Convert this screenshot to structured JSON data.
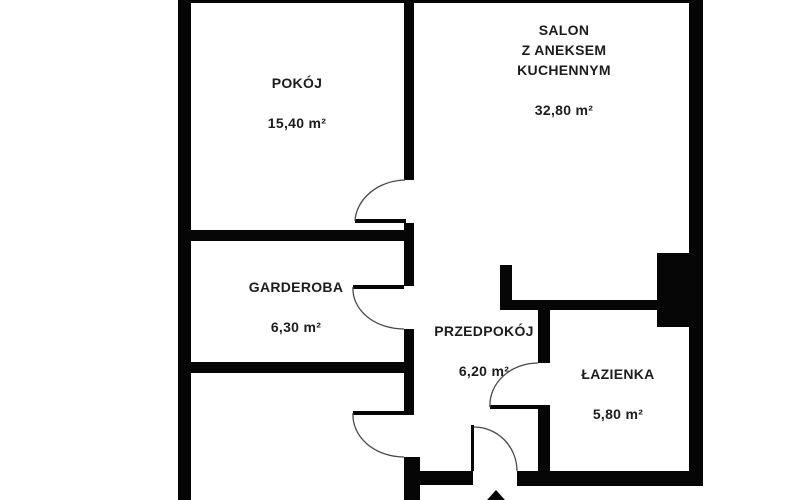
{
  "floorplan": {
    "canvas": {
      "width": 790,
      "height": 500
    },
    "colors": {
      "background": "#ffffff",
      "wall": "#060606",
      "door_arc": "#4a4a4a",
      "text": "#1c1c1c"
    },
    "rooms": [
      {
        "id": "pokoj",
        "name": "POKÓJ",
        "area": "15,40 m²",
        "label": {
          "x": 297,
          "y": 103
        }
      },
      {
        "id": "salon",
        "name": "SALON\nZ ANEKSEM\nKUCHENNYM",
        "area": "32,80 m²",
        "label": {
          "x": 564,
          "y": 70
        }
      },
      {
        "id": "garderoba",
        "name": "GARDEROBA",
        "area": "6,30 m²",
        "label": {
          "x": 296,
          "y": 307
        }
      },
      {
        "id": "przedpokoj",
        "name": "PRZEDPOKÓJ",
        "area": "6,20 m²",
        "label": {
          "x": 484,
          "y": 351
        }
      },
      {
        "id": "lazienka",
        "name": "ŁAZIENKA",
        "area": "5,80 m²",
        "label": {
          "x": 618,
          "y": 394
        }
      }
    ],
    "walls": [
      {
        "name": "outer-wall-left",
        "x": 178,
        "y": 0,
        "w": 13,
        "h": 500
      },
      {
        "name": "outer-wall-top",
        "x": 178,
        "y": 0,
        "w": 525,
        "h": 3
      },
      {
        "name": "outer-wall-right",
        "x": 689,
        "y": 0,
        "w": 14,
        "h": 486
      },
      {
        "name": "divider-wall-segment-a",
        "x": 404,
        "y": 0,
        "w": 10,
        "h": 180
      },
      {
        "name": "divider-wall-segment-b",
        "x": 404,
        "y": 223,
        "w": 10,
        "h": 63
      },
      {
        "name": "divider-wall-segment-c",
        "x": 404,
        "y": 329,
        "w": 10,
        "h": 86
      },
      {
        "name": "divider-wall-segment-d",
        "x": 404,
        "y": 457,
        "w": 16,
        "h": 43
      },
      {
        "name": "wall-pokoj-south",
        "x": 191,
        "y": 230,
        "w": 223,
        "h": 11
      },
      {
        "name": "wall-garderoba-south",
        "x": 191,
        "y": 362,
        "w": 213,
        "h": 11
      },
      {
        "name": "wall-salon-south",
        "x": 500,
        "y": 300,
        "w": 158,
        "h": 10
      },
      {
        "name": "wall-salon-stub",
        "x": 500,
        "y": 265,
        "w": 12,
        "h": 40
      },
      {
        "name": "shaft-block",
        "x": 657,
        "y": 253,
        "w": 32,
        "h": 74
      },
      {
        "name": "wall-lazienka-west-upper",
        "x": 538,
        "y": 303,
        "w": 12,
        "h": 60
      },
      {
        "name": "wall-lazienka-west-lower",
        "x": 538,
        "y": 405,
        "w": 12,
        "h": 66
      },
      {
        "name": "wall-south-west-segment",
        "x": 404,
        "y": 471,
        "w": 69,
        "h": 14
      },
      {
        "name": "wall-south-east-segment",
        "x": 517,
        "y": 471,
        "w": 186,
        "h": 15
      }
    ],
    "doors": [
      {
        "name": "door-pokoj",
        "leaf": {
          "x": 355,
          "y": 219,
          "w": 51,
          "h": 4
        },
        "arc": "M 355 221 A 52 43 0 0 1 405 180"
      },
      {
        "name": "door-garderoba",
        "leaf": {
          "x": 353,
          "y": 285,
          "w": 51,
          "h": 4
        },
        "arc": "M 353 287 A 51 40 0 0 0 404 329"
      },
      {
        "name": "door-south-room",
        "leaf": {
          "x": 353,
          "y": 411,
          "w": 51,
          "h": 4
        },
        "arc": "M 353 413 A 51 42 0 0 0 404 457"
      },
      {
        "name": "door-lazienka",
        "leaf": {
          "x": 490,
          "y": 405,
          "w": 50,
          "h": 4
        },
        "arc": "M 490 407 A 48 42 0 0 1 538 363"
      },
      {
        "name": "door-entrance",
        "leaf": {
          "x": 471,
          "y": 425,
          "w": 3,
          "h": 46
        },
        "arc": "M 474 427 A 43 44 0 0 1 517 471"
      }
    ],
    "entrance_arrow": {
      "points": "496,490 487,500 505,500"
    }
  }
}
